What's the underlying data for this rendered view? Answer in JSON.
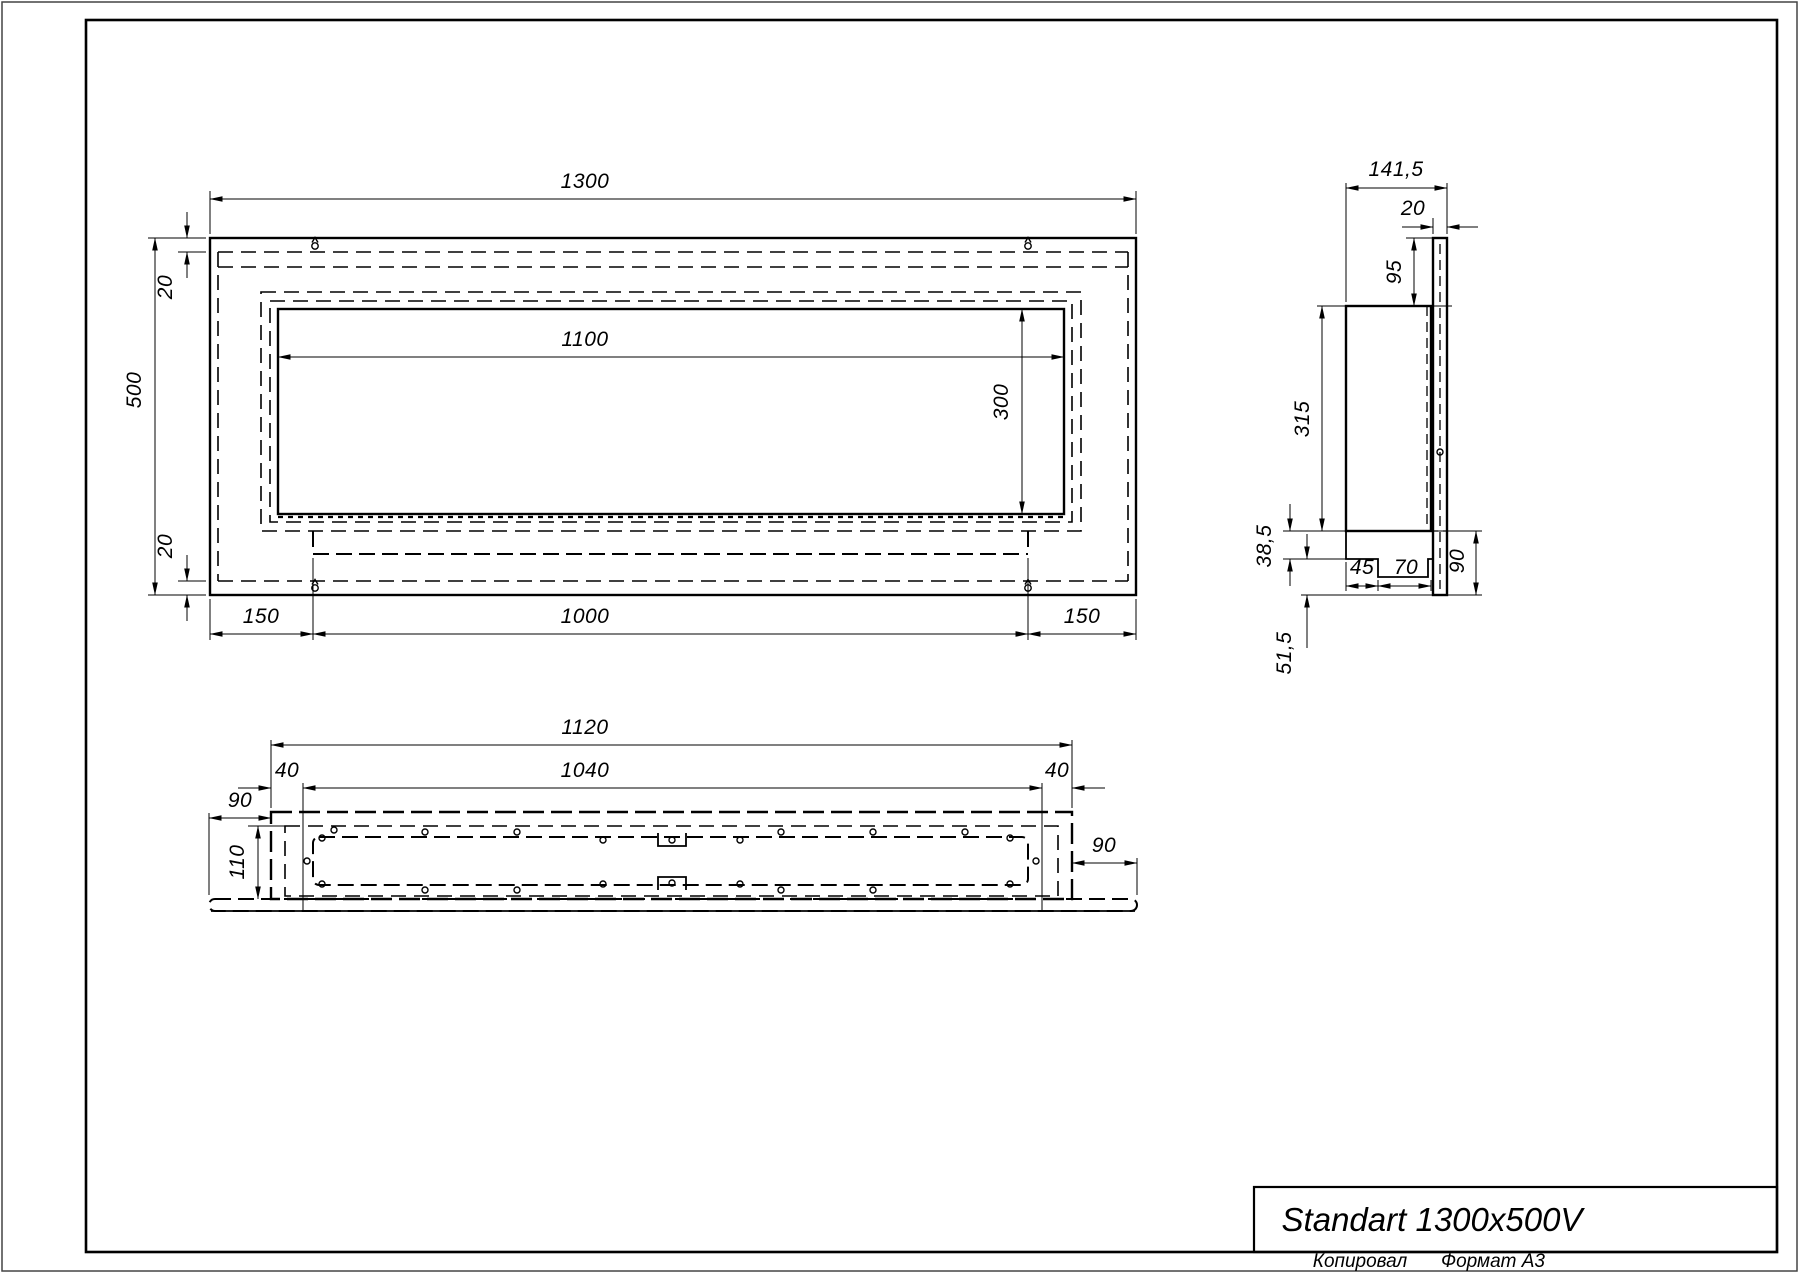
{
  "colors": {
    "line": "#000000",
    "border": "#444444",
    "background": "#ffffff"
  },
  "title_block": {
    "title": "Standart 1300x500V"
  },
  "footer": {
    "copied": "Копировал",
    "format": "Формат А3"
  },
  "front_view": {
    "dims": {
      "total_width": "1300",
      "total_height": "500",
      "flange_top": "20",
      "flange_bottom": "20",
      "opening_width": "1100",
      "opening_height": "300",
      "margin_left": "150",
      "tray_width": "1000",
      "margin_right": "150"
    }
  },
  "side_view": {
    "dims": {
      "total_depth": "141,5",
      "wall_plate_thickness": "20",
      "top_offset": "95",
      "body_height": "315",
      "step_height": "38,5",
      "step_a": "45",
      "step_b": "70",
      "plate_lower": "90",
      "bottom_offset": "51,5"
    }
  },
  "bottom_view": {
    "dims": {
      "body_width": "1120",
      "inset_left": "40",
      "tray_width": "1040",
      "inset_right": "40",
      "plate_left": "90",
      "depth": "110",
      "plate_right": "90"
    }
  }
}
